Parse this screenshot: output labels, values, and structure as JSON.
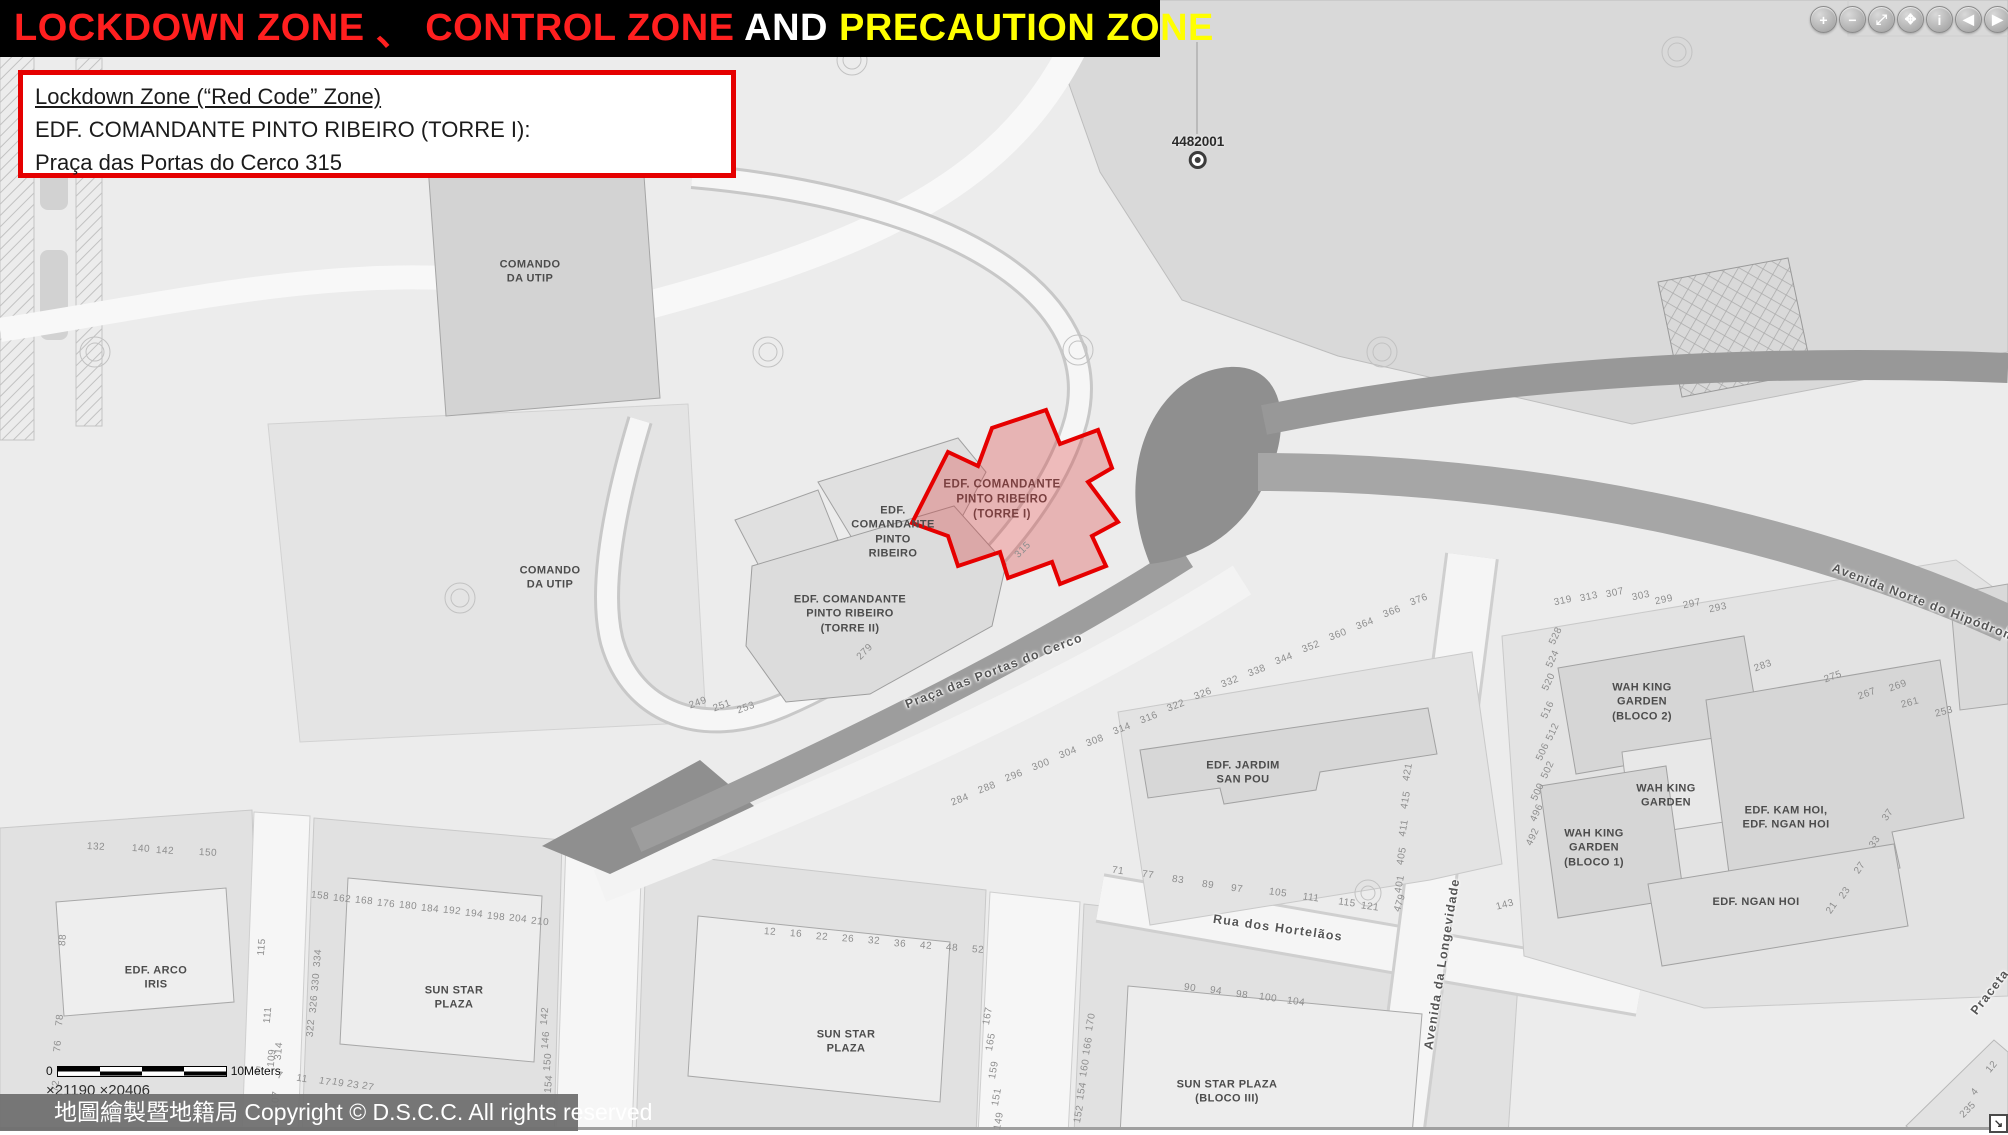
{
  "header": {
    "segments": [
      {
        "text": "LOCKDOWN ZONE",
        "color": "#ff1f1f"
      },
      {
        "text": " 、 ",
        "color": "#ff1f1f"
      },
      {
        "text": "CONTROL ZONE",
        "color": "#ff1f1f"
      },
      {
        "text": " AND ",
        "color": "#ffffff"
      },
      {
        "text": "PRECAUTION ZONE",
        "color": "#ffff00"
      }
    ]
  },
  "info_box": {
    "line1": "Lockdown Zone (“Red Code” Zone)",
    "line2": "EDF. COMANDANTE PINTO RIBEIRO (TORRE I):",
    "line3": "Praça das Portas do Cerco 315"
  },
  "toolbar": {
    "icons": [
      {
        "name": "zoom-in-icon",
        "glyph": "+"
      },
      {
        "name": "zoom-out-icon",
        "glyph": "−"
      },
      {
        "name": "full-extent-icon",
        "glyph": "⤢"
      },
      {
        "name": "pan-icon",
        "glyph": "✥"
      },
      {
        "name": "identify-icon",
        "glyph": "i"
      },
      {
        "name": "previous-extent-icon",
        "glyph": "◀"
      },
      {
        "name": "next-extent-icon",
        "glyph": "▶"
      }
    ]
  },
  "map": {
    "marker": {
      "label": "4482001"
    },
    "zone_color": "#e60000",
    "labels": [
      {
        "t": "COMANDO\nDA UTIP",
        "x": 530,
        "y": 272,
        "r": 0,
        "c": "b"
      },
      {
        "t": "COMANDO\nDA UTIP",
        "x": 550,
        "y": 578,
        "r": 0,
        "c": "b"
      },
      {
        "t": "EDF.\nCOMANDANTE\nPINTO\nRIBEIRO",
        "x": 893,
        "y": 532,
        "r": 0,
        "c": "b"
      },
      {
        "t": "EDF. COMANDANTE\nPINTO RIBEIRO\n(TORRE II)",
        "x": 850,
        "y": 614,
        "r": 0,
        "c": "b"
      },
      {
        "t": "EDF. COMANDANTE\nPINTO RIBEIRO\n(TORRE I)",
        "x": 1002,
        "y": 500,
        "r": 0,
        "c": "z"
      },
      {
        "t": "EDF. JARDIM\nSAN POU",
        "x": 1243,
        "y": 773,
        "r": 0,
        "c": "b"
      },
      {
        "t": "WAH KING\nGARDEN\n(BLOCO 2)",
        "x": 1642,
        "y": 702,
        "r": 0,
        "c": "b"
      },
      {
        "t": "WAH KING\nGARDEN",
        "x": 1666,
        "y": 796,
        "r": 0,
        "c": "b"
      },
      {
        "t": "WAH KING\nGARDEN\n(BLOCO 1)",
        "x": 1594,
        "y": 848,
        "r": 0,
        "c": "b"
      },
      {
        "t": "EDF. KAM HOI,\nEDF. NGAN HOI",
        "x": 1786,
        "y": 818,
        "r": 0,
        "c": "b"
      },
      {
        "t": "EDF. NGAN HOI",
        "x": 1756,
        "y": 902,
        "r": 0,
        "c": "b"
      },
      {
        "t": "EDF. ARCO\nIRIS",
        "x": 156,
        "y": 978,
        "r": 0,
        "c": "b"
      },
      {
        "t": "SUN STAR\nPLAZA",
        "x": 454,
        "y": 998,
        "r": 0,
        "c": "b"
      },
      {
        "t": "SUN STAR\nPLAZA",
        "x": 846,
        "y": 1042,
        "r": 0,
        "c": "b"
      },
      {
        "t": "SUN STAR PLAZA\n(BLOCO III)",
        "x": 1227,
        "y": 1092,
        "r": 0,
        "c": "b"
      },
      {
        "t": "Praça das Portas do Cerco",
        "x": 994,
        "y": 671,
        "r": -21,
        "c": "s"
      },
      {
        "t": "Rua dos Hortelãos",
        "x": 1278,
        "y": 928,
        "r": 8,
        "c": "s"
      },
      {
        "t": "Avenida da Longevidade",
        "x": 1442,
        "y": 964,
        "r": -81,
        "c": "s"
      },
      {
        "t": "Avenida Norte do Hipódromo",
        "x": 1928,
        "y": 604,
        "r": 21,
        "c": "s"
      },
      {
        "t": "Praceta",
        "x": 1990,
        "y": 992,
        "r": -52,
        "c": "s"
      },
      {
        "t": "315",
        "x": 1023,
        "y": 550,
        "r": -45,
        "c": "n"
      },
      {
        "t": "279",
        "x": 865,
        "y": 652,
        "r": -45,
        "c": "n"
      },
      {
        "t": "249",
        "x": 698,
        "y": 703,
        "r": -20,
        "c": "n"
      },
      {
        "t": "251",
        "x": 722,
        "y": 706,
        "r": -20,
        "c": "n"
      },
      {
        "t": "253",
        "x": 746,
        "y": 708,
        "r": -20,
        "c": "n"
      },
      {
        "t": "284",
        "x": 960,
        "y": 800,
        "r": -21,
        "c": "n"
      },
      {
        "t": "288",
        "x": 987,
        "y": 788,
        "r": -21,
        "c": "n"
      },
      {
        "t": "296",
        "x": 1014,
        "y": 776,
        "r": -21,
        "c": "n"
      },
      {
        "t": "300",
        "x": 1041,
        "y": 765,
        "r": -21,
        "c": "n"
      },
      {
        "t": "304",
        "x": 1068,
        "y": 753,
        "r": -21,
        "c": "n"
      },
      {
        "t": "308",
        "x": 1095,
        "y": 741,
        "r": -21,
        "c": "n"
      },
      {
        "t": "314",
        "x": 1122,
        "y": 729,
        "r": -21,
        "c": "n"
      },
      {
        "t": "316",
        "x": 1149,
        "y": 718,
        "r": -21,
        "c": "n"
      },
      {
        "t": "322",
        "x": 1176,
        "y": 706,
        "r": -21,
        "c": "n"
      },
      {
        "t": "326",
        "x": 1203,
        "y": 694,
        "r": -21,
        "c": "n"
      },
      {
        "t": "332",
        "x": 1230,
        "y": 682,
        "r": -21,
        "c": "n"
      },
      {
        "t": "338",
        "x": 1257,
        "y": 671,
        "r": -21,
        "c": "n"
      },
      {
        "t": "344",
        "x": 1284,
        "y": 659,
        "r": -21,
        "c": "n"
      },
      {
        "t": "352",
        "x": 1311,
        "y": 647,
        "r": -21,
        "c": "n"
      },
      {
        "t": "360",
        "x": 1338,
        "y": 635,
        "r": -21,
        "c": "n"
      },
      {
        "t": "364",
        "x": 1365,
        "y": 624,
        "r": -21,
        "c": "n"
      },
      {
        "t": "366",
        "x": 1392,
        "y": 612,
        "r": -21,
        "c": "n"
      },
      {
        "t": "376",
        "x": 1419,
        "y": 600,
        "r": -21,
        "c": "n"
      },
      {
        "t": "71",
        "x": 1118,
        "y": 871,
        "r": 8,
        "c": "n"
      },
      {
        "t": "77",
        "x": 1148,
        "y": 875,
        "r": 8,
        "c": "n"
      },
      {
        "t": "83",
        "x": 1178,
        "y": 880,
        "r": 8,
        "c": "n"
      },
      {
        "t": "89",
        "x": 1208,
        "y": 885,
        "r": 8,
        "c": "n"
      },
      {
        "t": "97",
        "x": 1237,
        "y": 889,
        "r": 8,
        "c": "n"
      },
      {
        "t": "105",
        "x": 1278,
        "y": 893,
        "r": 8,
        "c": "n"
      },
      {
        "t": "111",
        "x": 1311,
        "y": 898,
        "r": 8,
        "c": "n"
      },
      {
        "t": "115",
        "x": 1347,
        "y": 903,
        "r": 8,
        "c": "n"
      },
      {
        "t": "121",
        "x": 1370,
        "y": 907,
        "r": 8,
        "c": "n"
      },
      {
        "t": "479",
        "x": 1400,
        "y": 903,
        "r": -72,
        "c": "n"
      },
      {
        "t": "90",
        "x": 1190,
        "y": 988,
        "r": 8,
        "c": "n"
      },
      {
        "t": "94",
        "x": 1216,
        "y": 991,
        "r": 8,
        "c": "n"
      },
      {
        "t": "98",
        "x": 1242,
        "y": 995,
        "r": 8,
        "c": "n"
      },
      {
        "t": "100",
        "x": 1268,
        "y": 998,
        "r": 8,
        "c": "n"
      },
      {
        "t": "104",
        "x": 1296,
        "y": 1002,
        "r": 8,
        "c": "n"
      },
      {
        "t": "115",
        "x": 262,
        "y": 947,
        "r": -85,
        "c": "n"
      },
      {
        "t": "111",
        "x": 268,
        "y": 1015,
        "r": -85,
        "c": "n"
      },
      {
        "t": "109",
        "x": 272,
        "y": 1058,
        "r": -85,
        "c": "n"
      },
      {
        "t": "107",
        "x": 276,
        "y": 1100,
        "r": -85,
        "c": "n"
      },
      {
        "t": "334",
        "x": 318,
        "y": 958,
        "r": -85,
        "c": "n"
      },
      {
        "t": "330",
        "x": 316,
        "y": 982,
        "r": -85,
        "c": "n"
      },
      {
        "t": "326",
        "x": 314,
        "y": 1004,
        "r": -85,
        "c": "n"
      },
      {
        "t": "322",
        "x": 311,
        "y": 1028,
        "r": -85,
        "c": "n"
      },
      {
        "t": "314",
        "x": 279,
        "y": 1051,
        "r": -85,
        "c": "n"
      },
      {
        "t": "88",
        "x": 63,
        "y": 940,
        "r": -85,
        "c": "n"
      },
      {
        "t": "78",
        "x": 60,
        "y": 1020,
        "r": -85,
        "c": "n"
      },
      {
        "t": "76",
        "x": 58,
        "y": 1046,
        "r": -85,
        "c": "n"
      },
      {
        "t": "72",
        "x": 56,
        "y": 1086,
        "r": -85,
        "c": "n"
      },
      {
        "t": "132",
        "x": 96,
        "y": 847,
        "r": 3,
        "c": "n"
      },
      {
        "t": "140",
        "x": 141,
        "y": 849,
        "r": 3,
        "c": "n"
      },
      {
        "t": "142",
        "x": 165,
        "y": 851,
        "r": 3,
        "c": "n"
      },
      {
        "t": "150",
        "x": 208,
        "y": 853,
        "r": 3,
        "c": "n"
      },
      {
        "t": "158",
        "x": 320,
        "y": 896,
        "r": 6,
        "c": "n"
      },
      {
        "t": "162",
        "x": 342,
        "y": 899,
        "r": 6,
        "c": "n"
      },
      {
        "t": "168",
        "x": 364,
        "y": 901,
        "r": 6,
        "c": "n"
      },
      {
        "t": "176",
        "x": 386,
        "y": 904,
        "r": 6,
        "c": "n"
      },
      {
        "t": "180",
        "x": 408,
        "y": 906,
        "r": 6,
        "c": "n"
      },
      {
        "t": "184",
        "x": 430,
        "y": 909,
        "r": 6,
        "c": "n"
      },
      {
        "t": "192",
        "x": 452,
        "y": 911,
        "r": 6,
        "c": "n"
      },
      {
        "t": "194",
        "x": 474,
        "y": 914,
        "r": 6,
        "c": "n"
      },
      {
        "t": "198",
        "x": 496,
        "y": 917,
        "r": 6,
        "c": "n"
      },
      {
        "t": "204",
        "x": 518,
        "y": 919,
        "r": 6,
        "c": "n"
      },
      {
        "t": "210",
        "x": 540,
        "y": 922,
        "r": 6,
        "c": "n"
      },
      {
        "t": "12",
        "x": 770,
        "y": 932,
        "r": 4,
        "c": "n"
      },
      {
        "t": "16",
        "x": 796,
        "y": 934,
        "r": 4,
        "c": "n"
      },
      {
        "t": "22",
        "x": 822,
        "y": 937,
        "r": 4,
        "c": "n"
      },
      {
        "t": "26",
        "x": 848,
        "y": 939,
        "r": 4,
        "c": "n"
      },
      {
        "t": "32",
        "x": 874,
        "y": 941,
        "r": 4,
        "c": "n"
      },
      {
        "t": "36",
        "x": 900,
        "y": 944,
        "r": 4,
        "c": "n"
      },
      {
        "t": "42",
        "x": 926,
        "y": 946,
        "r": 4,
        "c": "n"
      },
      {
        "t": "48",
        "x": 952,
        "y": 948,
        "r": 4,
        "c": "n"
      },
      {
        "t": "52",
        "x": 978,
        "y": 950,
        "r": 4,
        "c": "n"
      },
      {
        "t": "142",
        "x": 545,
        "y": 1016,
        "r": -85,
        "c": "n"
      },
      {
        "t": "146",
        "x": 546,
        "y": 1040,
        "r": -85,
        "c": "n"
      },
      {
        "t": "150",
        "x": 548,
        "y": 1062,
        "r": -85,
        "c": "n"
      },
      {
        "t": "154",
        "x": 549,
        "y": 1084,
        "r": -85,
        "c": "n"
      },
      {
        "t": "167",
        "x": 988,
        "y": 1016,
        "r": -80,
        "c": "n"
      },
      {
        "t": "165",
        "x": 991,
        "y": 1042,
        "r": -80,
        "c": "n"
      },
      {
        "t": "159",
        "x": 994,
        "y": 1070,
        "r": -80,
        "c": "n"
      },
      {
        "t": "151",
        "x": 997,
        "y": 1097,
        "r": -80,
        "c": "n"
      },
      {
        "t": "149",
        "x": 999,
        "y": 1121,
        "r": -80,
        "c": "n"
      },
      {
        "t": "170",
        "x": 1091,
        "y": 1022,
        "r": -80,
        "c": "n"
      },
      {
        "t": "166",
        "x": 1088,
        "y": 1046,
        "r": -80,
        "c": "n"
      },
      {
        "t": "160",
        "x": 1085,
        "y": 1068,
        "r": -80,
        "c": "n"
      },
      {
        "t": "154",
        "x": 1082,
        "y": 1091,
        "r": -80,
        "c": "n"
      },
      {
        "t": "152",
        "x": 1079,
        "y": 1114,
        "r": -80,
        "c": "n"
      },
      {
        "t": "421",
        "x": 1408,
        "y": 772,
        "r": -80,
        "c": "n"
      },
      {
        "t": "415",
        "x": 1406,
        "y": 800,
        "r": -80,
        "c": "n"
      },
      {
        "t": "411",
        "x": 1404,
        "y": 828,
        "r": -80,
        "c": "n"
      },
      {
        "t": "405",
        "x": 1402,
        "y": 856,
        "r": -80,
        "c": "n"
      },
      {
        "t": "401",
        "x": 1400,
        "y": 884,
        "r": -80,
        "c": "n"
      },
      {
        "t": "528",
        "x": 1556,
        "y": 636,
        "r": -65,
        "c": "n"
      },
      {
        "t": "524",
        "x": 1553,
        "y": 659,
        "r": -65,
        "c": "n"
      },
      {
        "t": "520",
        "x": 1549,
        "y": 682,
        "r": -65,
        "c": "n"
      },
      {
        "t": "516",
        "x": 1548,
        "y": 710,
        "r": -65,
        "c": "n"
      },
      {
        "t": "512",
        "x": 1553,
        "y": 732,
        "r": -65,
        "c": "n"
      },
      {
        "t": "506",
        "x": 1543,
        "y": 752,
        "r": -65,
        "c": "n"
      },
      {
        "t": "502",
        "x": 1548,
        "y": 770,
        "r": -65,
        "c": "n"
      },
      {
        "t": "500",
        "x": 1538,
        "y": 792,
        "r": -65,
        "c": "n"
      },
      {
        "t": "496",
        "x": 1537,
        "y": 813,
        "r": -65,
        "c": "n"
      },
      {
        "t": "492",
        "x": 1533,
        "y": 837,
        "r": -65,
        "c": "n"
      },
      {
        "t": "319",
        "x": 1563,
        "y": 601,
        "r": -12,
        "c": "n"
      },
      {
        "t": "313",
        "x": 1589,
        "y": 597,
        "r": -12,
        "c": "n"
      },
      {
        "t": "307",
        "x": 1615,
        "y": 593,
        "r": -12,
        "c": "n"
      },
      {
        "t": "303",
        "x": 1641,
        "y": 596,
        "r": -12,
        "c": "n"
      },
      {
        "t": "299",
        "x": 1664,
        "y": 600,
        "r": -12,
        "c": "n"
      },
      {
        "t": "297",
        "x": 1692,
        "y": 604,
        "r": -12,
        "c": "n"
      },
      {
        "t": "293",
        "x": 1718,
        "y": 608,
        "r": -12,
        "c": "n"
      },
      {
        "t": "283",
        "x": 1763,
        "y": 666,
        "r": -20,
        "c": "n"
      },
      {
        "t": "275",
        "x": 1833,
        "y": 677,
        "r": -20,
        "c": "n"
      },
      {
        "t": "269",
        "x": 1898,
        "y": 686,
        "r": -20,
        "c": "n"
      },
      {
        "t": "267",
        "x": 1867,
        "y": 694,
        "r": -20,
        "c": "n"
      },
      {
        "t": "261",
        "x": 1910,
        "y": 703,
        "r": -15,
        "c": "n"
      },
      {
        "t": "253",
        "x": 1944,
        "y": 712,
        "r": -15,
        "c": "n"
      },
      {
        "t": "143",
        "x": 1505,
        "y": 905,
        "r": -15,
        "c": "n"
      },
      {
        "t": "37",
        "x": 1888,
        "y": 815,
        "r": -55,
        "c": "n"
      },
      {
        "t": "33",
        "x": 1875,
        "y": 842,
        "r": -55,
        "c": "n"
      },
      {
        "t": "27",
        "x": 1860,
        "y": 868,
        "r": -55,
        "c": "n"
      },
      {
        "t": "23",
        "x": 1845,
        "y": 893,
        "r": -55,
        "c": "n"
      },
      {
        "t": "21",
        "x": 1832,
        "y": 908,
        "r": -55,
        "c": "n"
      },
      {
        "t": "12",
        "x": 1992,
        "y": 1067,
        "r": -50,
        "c": "n"
      },
      {
        "t": "4",
        "x": 1975,
        "y": 1092,
        "r": -50,
        "c": "n"
      },
      {
        "t": "235",
        "x": 1968,
        "y": 1110,
        "r": -45,
        "c": "n"
      },
      {
        "t": "5",
        "x": 258,
        "y": 1071,
        "r": 10,
        "c": "n"
      },
      {
        "t": "7",
        "x": 280,
        "y": 1076,
        "r": 10,
        "c": "n"
      },
      {
        "t": "11",
        "x": 302,
        "y": 1079,
        "r": 10,
        "c": "n"
      },
      {
        "t": "17",
        "x": 325,
        "y": 1082,
        "r": 12,
        "c": "n"
      },
      {
        "t": "19",
        "x": 338,
        "y": 1083,
        "r": 12,
        "c": "n"
      },
      {
        "t": "23",
        "x": 353,
        "y": 1085,
        "r": 12,
        "c": "n"
      },
      {
        "t": "27",
        "x": 368,
        "y": 1087,
        "r": 12,
        "c": "n"
      }
    ]
  },
  "footer": {
    "scale_zero": "0",
    "scale_label": "10Meters",
    "coords": "×21190 ×20406",
    "copyright": "地圖繪製暨地籍局 Copyright © D.S.C.C. All rights reserved",
    "resize_glyph": "↘"
  }
}
